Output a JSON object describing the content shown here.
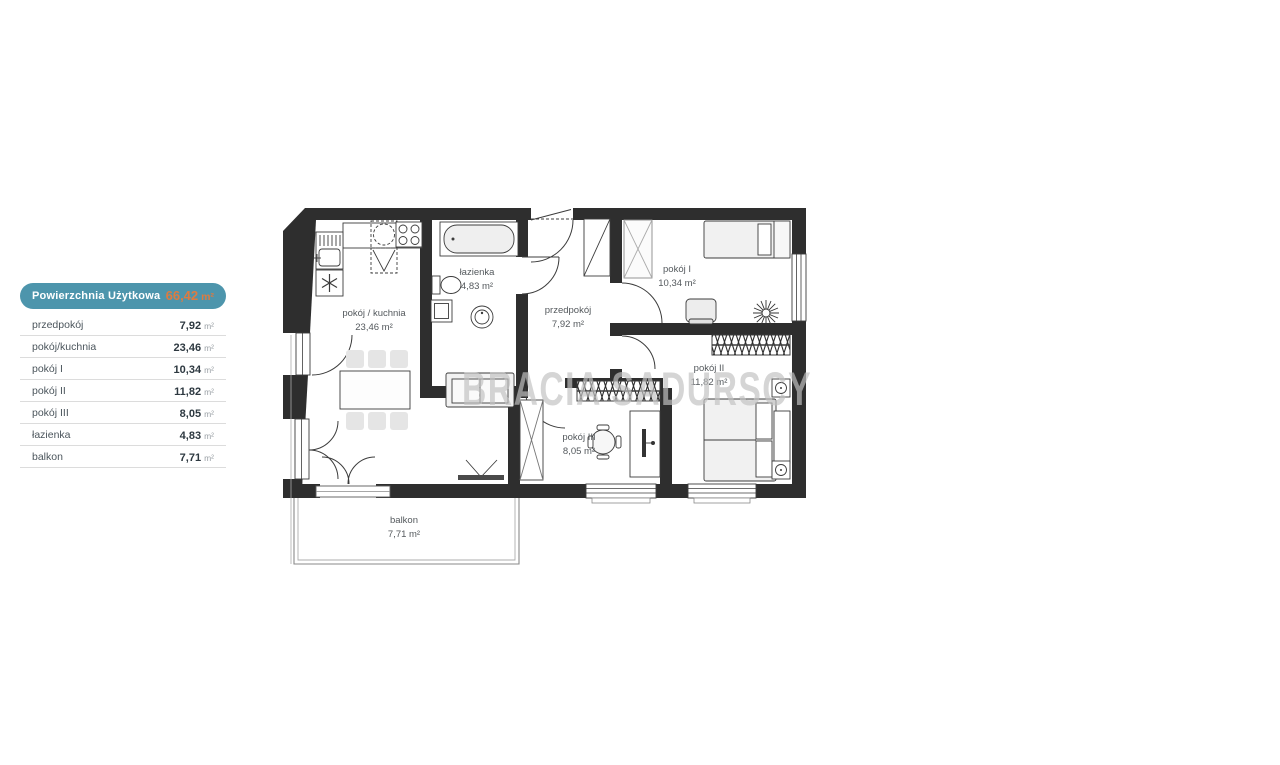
{
  "legend": {
    "header": {
      "label": "Powierzchnia Użytkowa",
      "value": "66,42",
      "unit": "m²"
    },
    "rows": [
      {
        "name": "przedpokój",
        "value": "7,92",
        "unit": "m²"
      },
      {
        "name": "pokój/kuchnia",
        "value": "23,46",
        "unit": "m²"
      },
      {
        "name": "pokój I",
        "value": "10,34",
        "unit": "m²"
      },
      {
        "name": "pokój II",
        "value": "11,82",
        "unit": "m²"
      },
      {
        "name": "pokój III",
        "value": "8,05",
        "unit": "m²"
      },
      {
        "name": "łazienka",
        "value": "4,83",
        "unit": "m²"
      },
      {
        "name": "balkon",
        "value": "7,71",
        "unit": "m²"
      }
    ],
    "colors": {
      "header_bg": "#4d95ac",
      "header_value": "#de7b40"
    }
  },
  "floorplan": {
    "watermark": "BRACIA SADURSCY",
    "wall_color": "#2e2e2e",
    "rooms": [
      {
        "name": "pokój / kuchnia",
        "area": "23,46 m²"
      },
      {
        "name": "łazienka",
        "area": "4,83 m²"
      },
      {
        "name": "przedpokój",
        "area": "7,92 m²"
      },
      {
        "name": "pokój I",
        "area": "10,34 m²"
      },
      {
        "name": "pokój II",
        "area": "11,82 m²"
      },
      {
        "name": "pokój III",
        "area": "8,05 m²"
      },
      {
        "name": "balkon",
        "area": "7,71 m²"
      }
    ]
  }
}
